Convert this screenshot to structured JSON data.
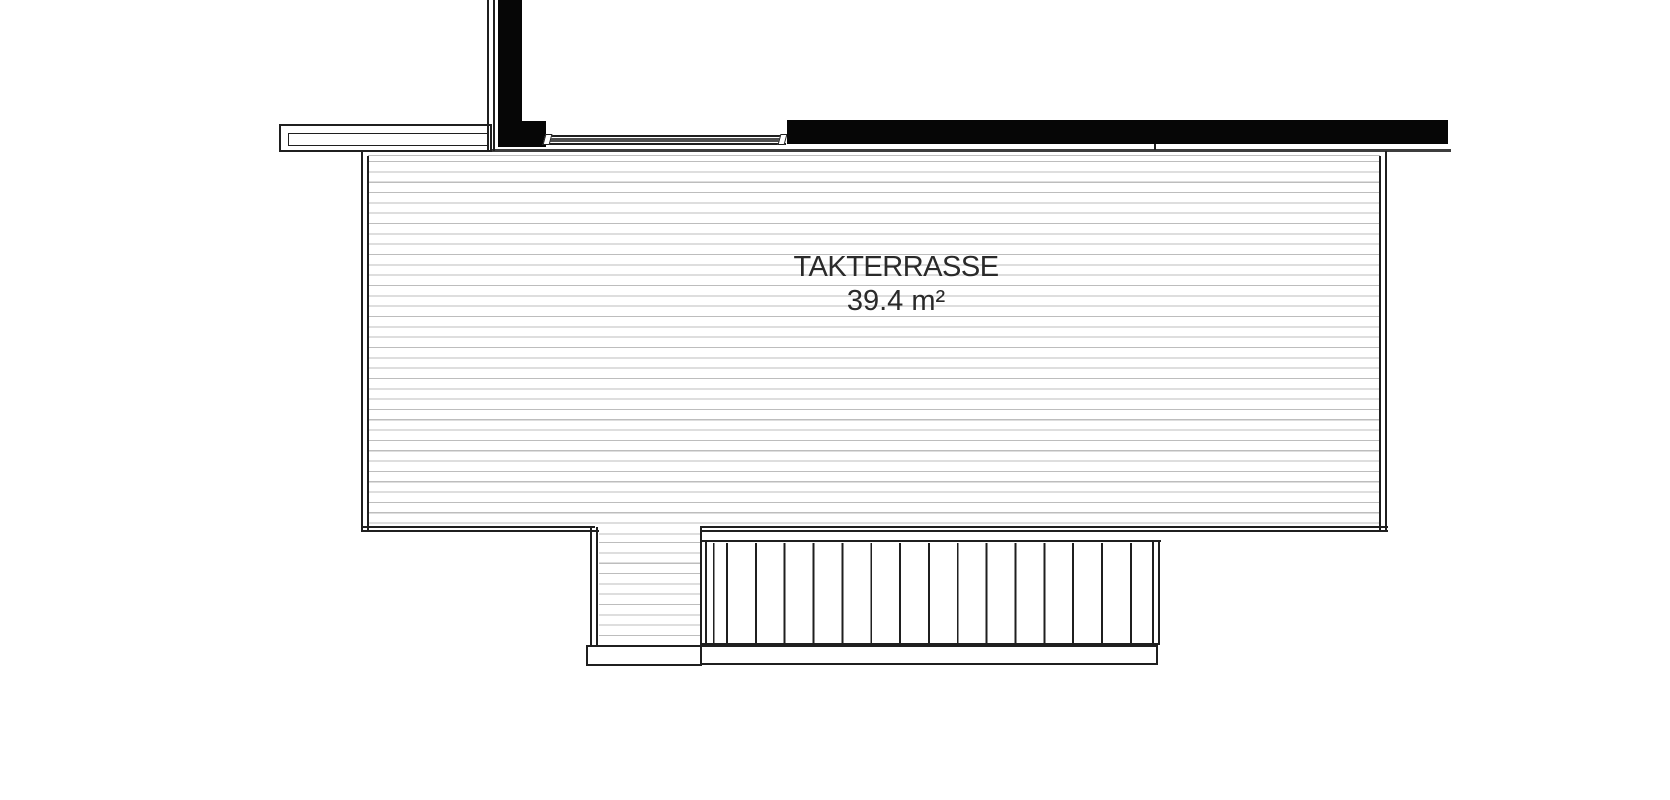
{
  "room": {
    "name": "TAKTERRASSE",
    "area": "39.4 m²"
  },
  "colors": {
    "ink": "#1f1f1f",
    "wall": "#060606",
    "edge": "#3d3d3d",
    "deck_line": "#bdbdbd",
    "window_fill": "#4e4e4e",
    "text": "#2a2a2a",
    "background": "#ffffff",
    "white": "#ffffff"
  },
  "patterns": {
    "deck": {
      "dir": "180deg",
      "line": "deck_line",
      "thick": 1.1,
      "period": 10.33
    },
    "treads": {
      "dir": "90deg",
      "line": "ink",
      "thick": 1.9,
      "period": 28.85
    }
  },
  "plan_notes": {
    "type": "architectural-roof-terrace-plan",
    "stairs_tread_count": 16,
    "decking_direction": "horizontal",
    "stair_direction": "vertical"
  },
  "shapes": [
    {
      "name": "building-edge-line",
      "x": 279,
      "y": 149,
      "w": 1172,
      "h": 3,
      "fill": "edge"
    },
    {
      "name": "railing-outer",
      "x": 279,
      "y": 124,
      "w": 213,
      "h": 28,
      "fill": "white",
      "border": {
        "w": 2,
        "color": "ink"
      }
    },
    {
      "name": "railing-inner",
      "x": 288,
      "y": 133,
      "w": 200,
      "h": 13,
      "fill": "white",
      "border": {
        "w": 1.5,
        "color": "ink"
      }
    },
    {
      "name": "partition-wall-line-outer",
      "x": 487,
      "y": 0,
      "w": 2,
      "h": 151,
      "fill": "ink"
    },
    {
      "name": "partition-wall-line-inner",
      "x": 493,
      "y": 0,
      "w": 2,
      "h": 151,
      "fill": "ink"
    },
    {
      "name": "wall-black-vertical",
      "x": 498,
      "y": 0,
      "w": 24,
      "h": 125,
      "fill": "wall"
    },
    {
      "name": "wall-black-foot",
      "x": 498,
      "y": 121,
      "w": 48,
      "h": 26,
      "fill": "wall"
    },
    {
      "name": "window-frame-top",
      "x": 546,
      "y": 135,
      "w": 240,
      "h": 2,
      "fill": "ink"
    },
    {
      "name": "window-glazing",
      "x": 549,
      "y": 138,
      "w": 234,
      "h": 4,
      "fill": "window_fill"
    },
    {
      "name": "window-frame-bottom",
      "x": 546,
      "y": 143,
      "w": 240,
      "h": 2,
      "fill": "ink"
    },
    {
      "name": "window-jamb-left",
      "x": 544,
      "y": 134,
      "w": 7,
      "h": 11,
      "fill": "white",
      "border": {
        "w": 1.5,
        "color": "ink"
      },
      "skew": true
    },
    {
      "name": "window-jamb-right",
      "x": 779,
      "y": 134,
      "w": 7,
      "h": 11,
      "fill": "white",
      "border": {
        "w": 1.5,
        "color": "ink"
      },
      "skew": true
    },
    {
      "name": "wall-black-top-right",
      "x": 787,
      "y": 120,
      "w": 661,
      "h": 24,
      "fill": "wall"
    },
    {
      "name": "wall-joint-line",
      "x": 1154,
      "y": 144,
      "w": 2,
      "h": 6,
      "fill": "ink"
    },
    {
      "name": "terrace-decking",
      "x": 368,
      "y": 152,
      "w": 1012,
      "h": 378,
      "pattern": "deck",
      "bg_offset": "0px 9px"
    },
    {
      "name": "terrace-edge-left-outer",
      "x": 361,
      "y": 151,
      "w": 2,
      "h": 381,
      "fill": "ink"
    },
    {
      "name": "terrace-edge-left-inner",
      "x": 367,
      "y": 156,
      "w": 2,
      "h": 376,
      "fill": "ink"
    },
    {
      "name": "terrace-edge-right-inner",
      "x": 1379,
      "y": 156,
      "w": 2,
      "h": 376,
      "fill": "ink"
    },
    {
      "name": "terrace-edge-right-outer",
      "x": 1385,
      "y": 151,
      "w": 2,
      "h": 381,
      "fill": "ink"
    },
    {
      "name": "terrace-edge-bottom-left-inner",
      "x": 361,
      "y": 526,
      "w": 234,
      "h": 2,
      "fill": "ink"
    },
    {
      "name": "terrace-edge-bottom-left-outer",
      "x": 361,
      "y": 530,
      "w": 238,
      "h": 2,
      "fill": "ink"
    },
    {
      "name": "terrace-edge-bottom-right-inner",
      "x": 700,
      "y": 526,
      "w": 688,
      "h": 2,
      "fill": "ink"
    },
    {
      "name": "terrace-edge-bottom-right-outer",
      "x": 700,
      "y": 530,
      "w": 688,
      "h": 2,
      "fill": "ink"
    },
    {
      "name": "walkway-decking",
      "x": 599,
      "y": 532,
      "w": 101,
      "h": 112,
      "pattern": "deck",
      "bg_offset": "0px 10px"
    },
    {
      "name": "walkway-edge-left-outer",
      "x": 590,
      "y": 527,
      "w": 2,
      "h": 118,
      "fill": "ink"
    },
    {
      "name": "walkway-edge-left-inner",
      "x": 596,
      "y": 527,
      "w": 2,
      "h": 118,
      "fill": "ink"
    },
    {
      "name": "stairs-top-edge",
      "x": 700,
      "y": 540,
      "w": 461,
      "h": 2,
      "fill": "ink"
    },
    {
      "name": "stairs-stringer-left-outer",
      "x": 700,
      "y": 527,
      "w": 2,
      "h": 118,
      "fill": "ink"
    },
    {
      "name": "stairs-stringer-left-inner",
      "x": 705,
      "y": 541,
      "w": 2,
      "h": 103,
      "fill": "ink"
    },
    {
      "name": "stairs-treads",
      "x": 707,
      "y": 543,
      "w": 446,
      "h": 100,
      "pattern": "treads",
      "bg_offset": "19px 0px"
    },
    {
      "name": "stairs-stringer-right-inner",
      "x": 1152,
      "y": 541,
      "w": 2,
      "h": 104,
      "fill": "ink"
    },
    {
      "name": "stairs-stringer-right-outer",
      "x": 1158,
      "y": 541,
      "w": 2,
      "h": 104,
      "fill": "ink"
    },
    {
      "name": "stairs-bottom-edge",
      "x": 700,
      "y": 643,
      "w": 460,
      "h": 2,
      "fill": "ink"
    },
    {
      "name": "landing-left",
      "x": 586,
      "y": 645,
      "w": 116,
      "h": 21,
      "fill": "white",
      "border": {
        "w": 2,
        "color": "ink"
      }
    },
    {
      "name": "landing-right",
      "x": 700,
      "y": 645,
      "w": 458,
      "h": 20,
      "fill": "white",
      "border": {
        "w": 2,
        "color": "ink"
      }
    }
  ]
}
